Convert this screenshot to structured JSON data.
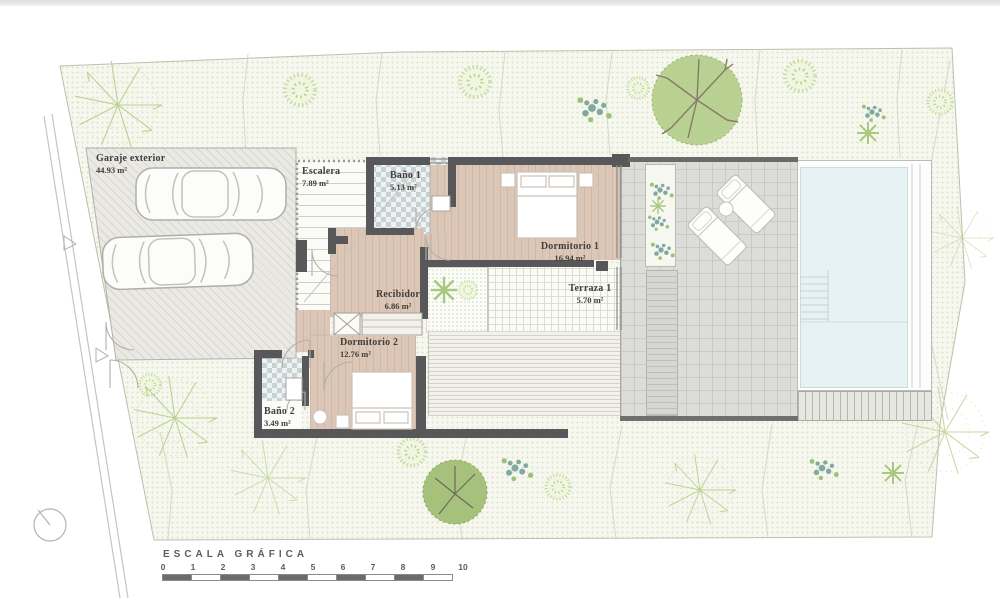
{
  "plan": {
    "rooms": [
      {
        "label": "Garaje exterior",
        "area": "44.93 m²"
      },
      {
        "label": "Escalera",
        "area": "7.89 m²"
      },
      {
        "label": "Baño 1",
        "area": "5.13 m²"
      },
      {
        "label": "Dormitorio 1",
        "area": "16.94 m²"
      },
      {
        "label": "Recibidor",
        "area": "6.86 m²"
      },
      {
        "label": "Terraza 1",
        "area": "5.70 m²"
      },
      {
        "label": "Dormitorio 2",
        "area": "12.76 m²"
      },
      {
        "label": "Baño 2",
        "area": "3.49 m²"
      }
    ]
  },
  "scale_bar": {
    "title": "ESCALA GRÁFICA",
    "ticks": [
      "0",
      "1",
      "2",
      "3",
      "4",
      "5",
      "6",
      "7",
      "8",
      "9",
      "10"
    ],
    "filled_segments": [
      0,
      2,
      4,
      6,
      8
    ]
  },
  "colors": {
    "wall": "#58585a",
    "wood_floor": "#dcc7b7",
    "bath_tile": "#c7d2d3",
    "pool_water": "#e7f2f4",
    "deck": "#dcdcd9",
    "site": "#f6f7ee",
    "vegetation_light": "#c8dca4",
    "vegetation_dark": "#a5c17b",
    "vegetation_teal": "#82a9a1"
  }
}
